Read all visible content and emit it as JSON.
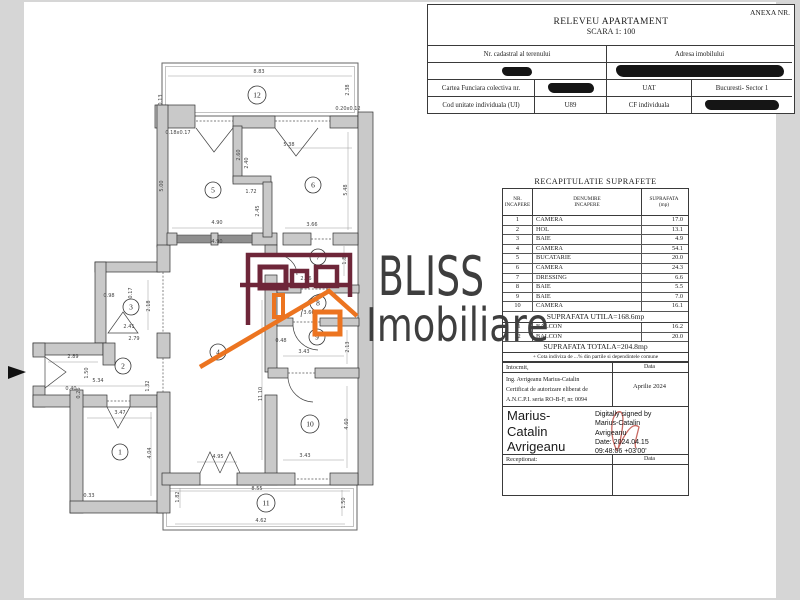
{
  "colors": {
    "maroon": "#6e2639",
    "orange": "#ec7420",
    "redaction": "#151515",
    "signature_red": "#c96a63",
    "wm_text": "#3e3e3e"
  },
  "header": {
    "anexa": "ANEXA NR.",
    "title": "RELEVEU APARTAMENT",
    "scale": "SCARA 1: 100",
    "table": {
      "nr_cadastral_label": "Nr. cadastral al terenului",
      "adresa_label": "Adresa imobilului",
      "cartea_funciara_label": "Cartea Funciara colectiva nr.",
      "uat_label": "UAT",
      "uat_value": "Bucuresti- Sector 1",
      "cod_unitate_label": "Cod unitate individuala (UI)",
      "cod_unitate_value": "U89",
      "cf_label": "CF individuala"
    }
  },
  "surfaces": {
    "title": "RECAPITULATIE SUPRAFETE",
    "col_headers": [
      [
        "NR.",
        "INCAPERE"
      ],
      [
        "DENUMIRE",
        "INCAPERE"
      ],
      [
        "SUPRAFATA",
        "(mp)"
      ]
    ],
    "rows": [
      [
        "1",
        "CAMERA",
        "17.0"
      ],
      [
        "2",
        "HOL",
        "13.1"
      ],
      [
        "3",
        "BAIE",
        "4.9"
      ],
      [
        "4",
        "CAMERA",
        "54.1"
      ],
      [
        "5",
        "BUCATARIE",
        "20.0"
      ],
      [
        "6",
        "CAMERA",
        "24.3"
      ],
      [
        "7",
        "DRESSING",
        "6.6"
      ],
      [
        "8",
        "BAIE",
        "5.5"
      ],
      [
        "9",
        "BAIE",
        "7.0"
      ],
      [
        "10",
        "CAMERA",
        "16.1"
      ]
    ],
    "utila": "SUPRAFATA UTILA=168.6mp",
    "balcony_rows": [
      [
        "11",
        "BALCON",
        "16.2"
      ],
      [
        "12",
        "BALCON",
        "20.0"
      ]
    ],
    "totala": "SUPRAFATA TOTALA=204.8mp",
    "note": "+ Cota indiviza de ...% din partile si dependintele comune"
  },
  "signing": {
    "intocmit_label": "Intocmit,",
    "data_label": "Data",
    "engineer_lines": [
      "Ing. Avrigeanu Marius-Catalin",
      "Certificat de autorizare eliberat de",
      "A.N.C.P.I. seria RO-B-F, nr. 0094"
    ],
    "date_value": "Aprilie 2024",
    "signature_lines": [
      "Marius-",
      "Catalin",
      "Avrigeanu"
    ],
    "stamp_lines": [
      "Digitally signed by",
      "Marius-Catalin",
      "Avrigeanu",
      "Date: 2024.04.15",
      "09:48:06 +03'00'"
    ],
    "receptionat_label": "Receptionat:",
    "data_label2": "Data"
  },
  "watermark": {
    "line1": "BLISS",
    "line2": "Imobiliare"
  },
  "floorplan": {
    "rooms": [
      {
        "n": "1",
        "x": 120,
        "y": 452
      },
      {
        "n": "2",
        "x": 123,
        "y": 366
      },
      {
        "n": "3",
        "x": 131,
        "y": 307
      },
      {
        "n": "4",
        "x": 218,
        "y": 352
      },
      {
        "n": "5",
        "x": 213,
        "y": 190
      },
      {
        "n": "6",
        "x": 313,
        "y": 185
      },
      {
        "n": "7",
        "x": 318,
        "y": 257
      },
      {
        "n": "8",
        "x": 318,
        "y": 303
      },
      {
        "n": "9",
        "x": 317,
        "y": 337
      },
      {
        "n": "10",
        "x": 310,
        "y": 424
      },
      {
        "n": "11",
        "x": 266,
        "y": 503
      },
      {
        "n": "12",
        "x": 257,
        "y": 95
      }
    ],
    "dims": [
      {
        "t": "8.83",
        "x": 259,
        "y": 73
      },
      {
        "t": "2.38",
        "x": 349,
        "y": 90,
        "r": 1
      },
      {
        "t": "0.13",
        "x": 162,
        "y": 100,
        "r": 1
      },
      {
        "t": "0.18x0.17",
        "x": 178,
        "y": 134
      },
      {
        "t": "0.20x0.12",
        "x": 348,
        "y": 110
      },
      {
        "t": "5.38",
        "x": 289,
        "y": 146
      },
      {
        "t": "2.60",
        "x": 240,
        "y": 155,
        "r": 1
      },
      {
        "t": "2.40",
        "x": 248,
        "y": 163,
        "r": 1
      },
      {
        "t": "5.00",
        "x": 163,
        "y": 186,
        "r": 1
      },
      {
        "t": "5.48",
        "x": 347,
        "y": 190,
        "r": 1
      },
      {
        "t": "1.72",
        "x": 251,
        "y": 193
      },
      {
        "t": "2.45",
        "x": 259,
        "y": 211,
        "r": 1
      },
      {
        "t": "4.90",
        "x": 217,
        "y": 224
      },
      {
        "t": "3.66",
        "x": 312,
        "y": 226
      },
      {
        "t": "4.90",
        "x": 217,
        "y": 243
      },
      {
        "t": "1.80",
        "x": 346,
        "y": 259,
        "r": 1
      },
      {
        "t": "2.66",
        "x": 306,
        "y": 280
      },
      {
        "t": "3.66",
        "x": 309,
        "y": 314
      },
      {
        "t": "0.48",
        "x": 281,
        "y": 342
      },
      {
        "t": "3.43",
        "x": 304,
        "y": 353
      },
      {
        "t": "2.13",
        "x": 349,
        "y": 347,
        "r": 1
      },
      {
        "t": "11.10",
        "x": 262,
        "y": 394,
        "r": 1
      },
      {
        "t": "4.60",
        "x": 348,
        "y": 424,
        "r": 1
      },
      {
        "t": "3.43",
        "x": 305,
        "y": 457
      },
      {
        "t": "4.95",
        "x": 218,
        "y": 458
      },
      {
        "t": "0.98",
        "x": 109,
        "y": 297
      },
      {
        "t": "0.17",
        "x": 132,
        "y": 293,
        "r": 1
      },
      {
        "t": "2.18",
        "x": 150,
        "y": 306,
        "r": 1
      },
      {
        "t": "2.41",
        "x": 129,
        "y": 328
      },
      {
        "t": "2.79",
        "x": 134,
        "y": 340
      },
      {
        "t": "2.89",
        "x": 73,
        "y": 358
      },
      {
        "t": "1.50",
        "x": 88,
        "y": 373,
        "r": 1
      },
      {
        "t": "5.34",
        "x": 98,
        "y": 382
      },
      {
        "t": "0.40",
        "x": 71,
        "y": 390
      },
      {
        "t": "0.26",
        "x": 80,
        "y": 393,
        "r": 1
      },
      {
        "t": "1.32",
        "x": 149,
        "y": 386,
        "r": 1
      },
      {
        "t": "3.47",
        "x": 120,
        "y": 414
      },
      {
        "t": "4.04",
        "x": 151,
        "y": 453,
        "r": 1
      },
      {
        "t": "0.33",
        "x": 89,
        "y": 497
      },
      {
        "t": "1.82",
        "x": 179,
        "y": 497,
        "r": 1
      },
      {
        "t": "8.55",
        "x": 257,
        "y": 490
      },
      {
        "t": "4.62",
        "x": 261,
        "y": 522
      },
      {
        "t": "1.50",
        "x": 345,
        "y": 503,
        "r": 1
      }
    ]
  }
}
